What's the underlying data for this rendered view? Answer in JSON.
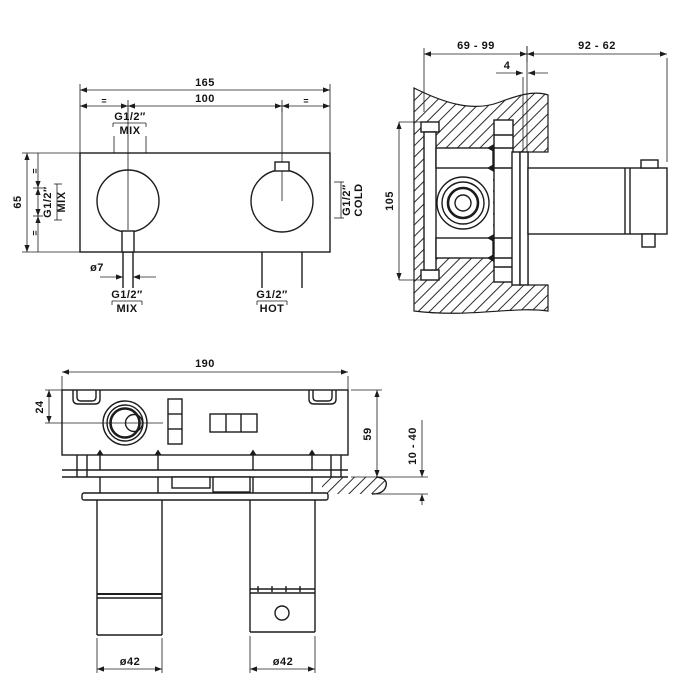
{
  "drawing": {
    "front_view": {
      "dim_total_width": "165",
      "dim_center_distance": "100",
      "dim_height": "65",
      "dim_pin_diameter": "ø7",
      "equal_mark": "=",
      "port_top_size": "G1/2″",
      "port_top_label": "MIX",
      "port_left_size": "G1/2″",
      "port_left_label": "MIX",
      "port_right_size": "G1/2″",
      "port_right_label": "COLD",
      "port_bottom_left_size": "G1/2″",
      "port_bottom_left_label": "MIX",
      "port_bottom_right_size": "G1/2″",
      "port_bottom_right_label": "HOT"
    },
    "section_view": {
      "dim_recess_depth": "69 - 99",
      "dim_protrusion": "92 - 62",
      "dim_plate_offset": "4",
      "dim_body_height": "105"
    },
    "bottom_view": {
      "dim_total_width": "190",
      "dim_cartridge_offset": "24",
      "dim_body_depth": "59",
      "dim_wall_thickness_range": "10 - 40",
      "dim_left_handle_diameter": "ø42",
      "dim_right_handle_diameter": "ø42"
    },
    "colors": {
      "line": "#1c1c1c",
      "background": "#ffffff"
    }
  }
}
